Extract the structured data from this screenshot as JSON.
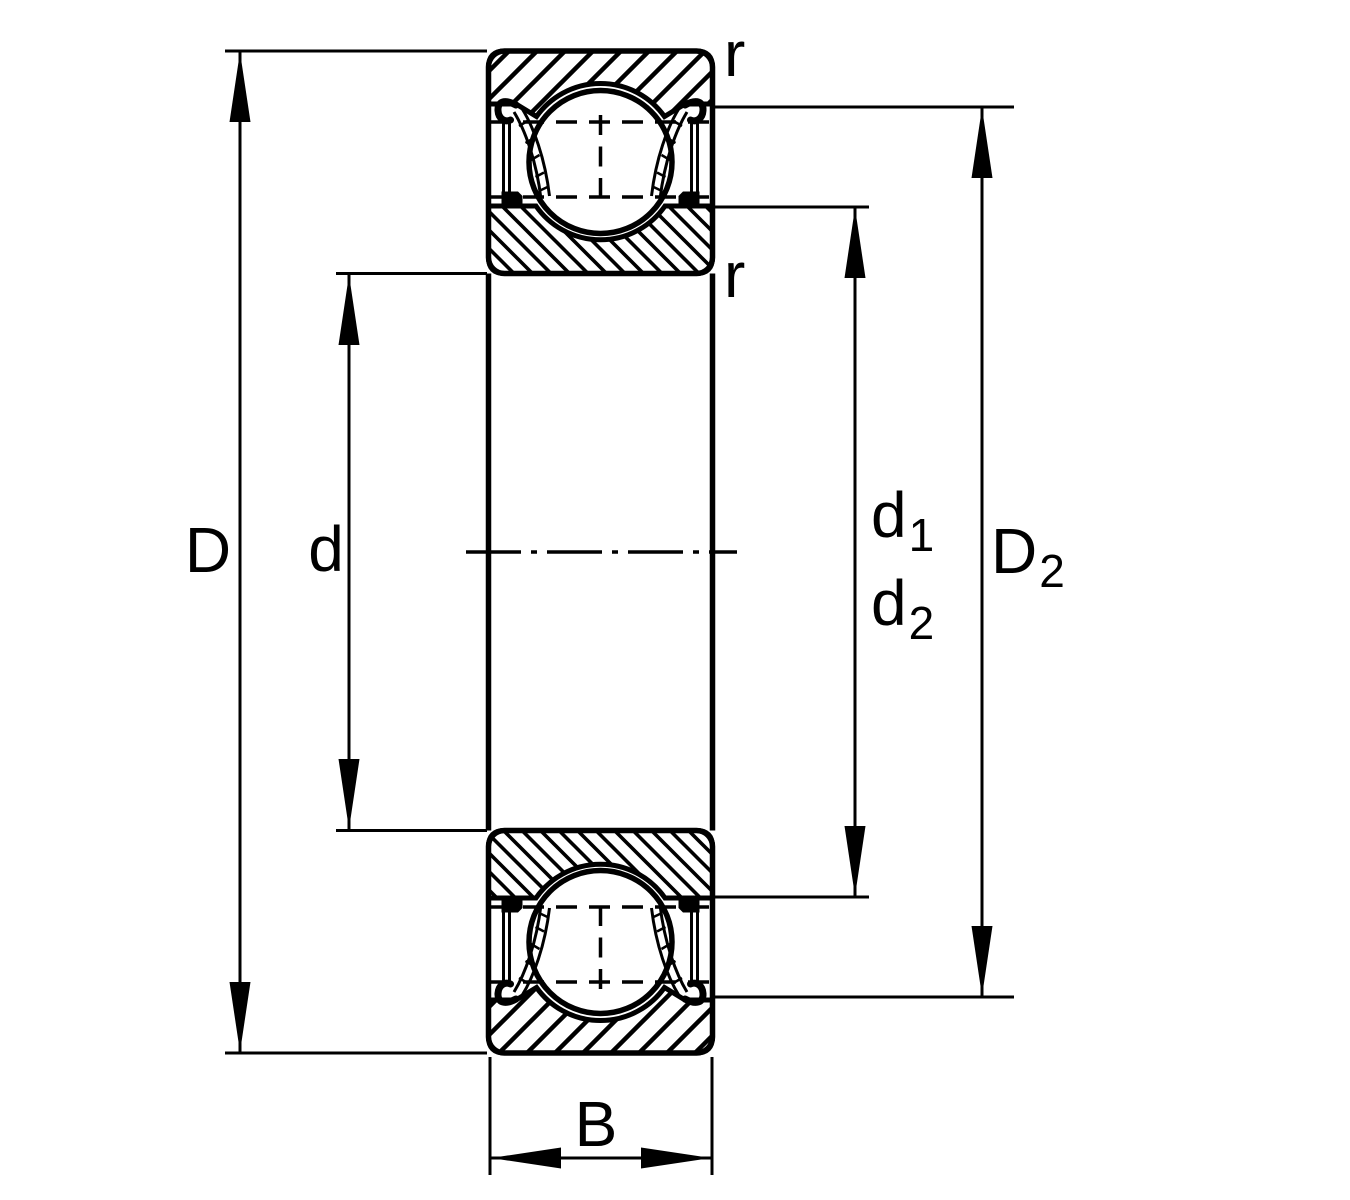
{
  "drawing": {
    "kind": "deep-groove-ball-bearing-cross-section-dimension-drawing",
    "colors": {
      "line": "#000000",
      "background": "#ffffff"
    },
    "labels": {
      "outer_diameter": "D",
      "bore_diameter": "d",
      "shoulder_d1": {
        "base": "d",
        "sub": "1"
      },
      "shoulder_d2": {
        "base": "d",
        "sub": "2"
      },
      "recess_D2": {
        "base": "D",
        "sub": "2"
      },
      "width": "B",
      "radius_outer": "r",
      "radius_inner": "r"
    }
  }
}
